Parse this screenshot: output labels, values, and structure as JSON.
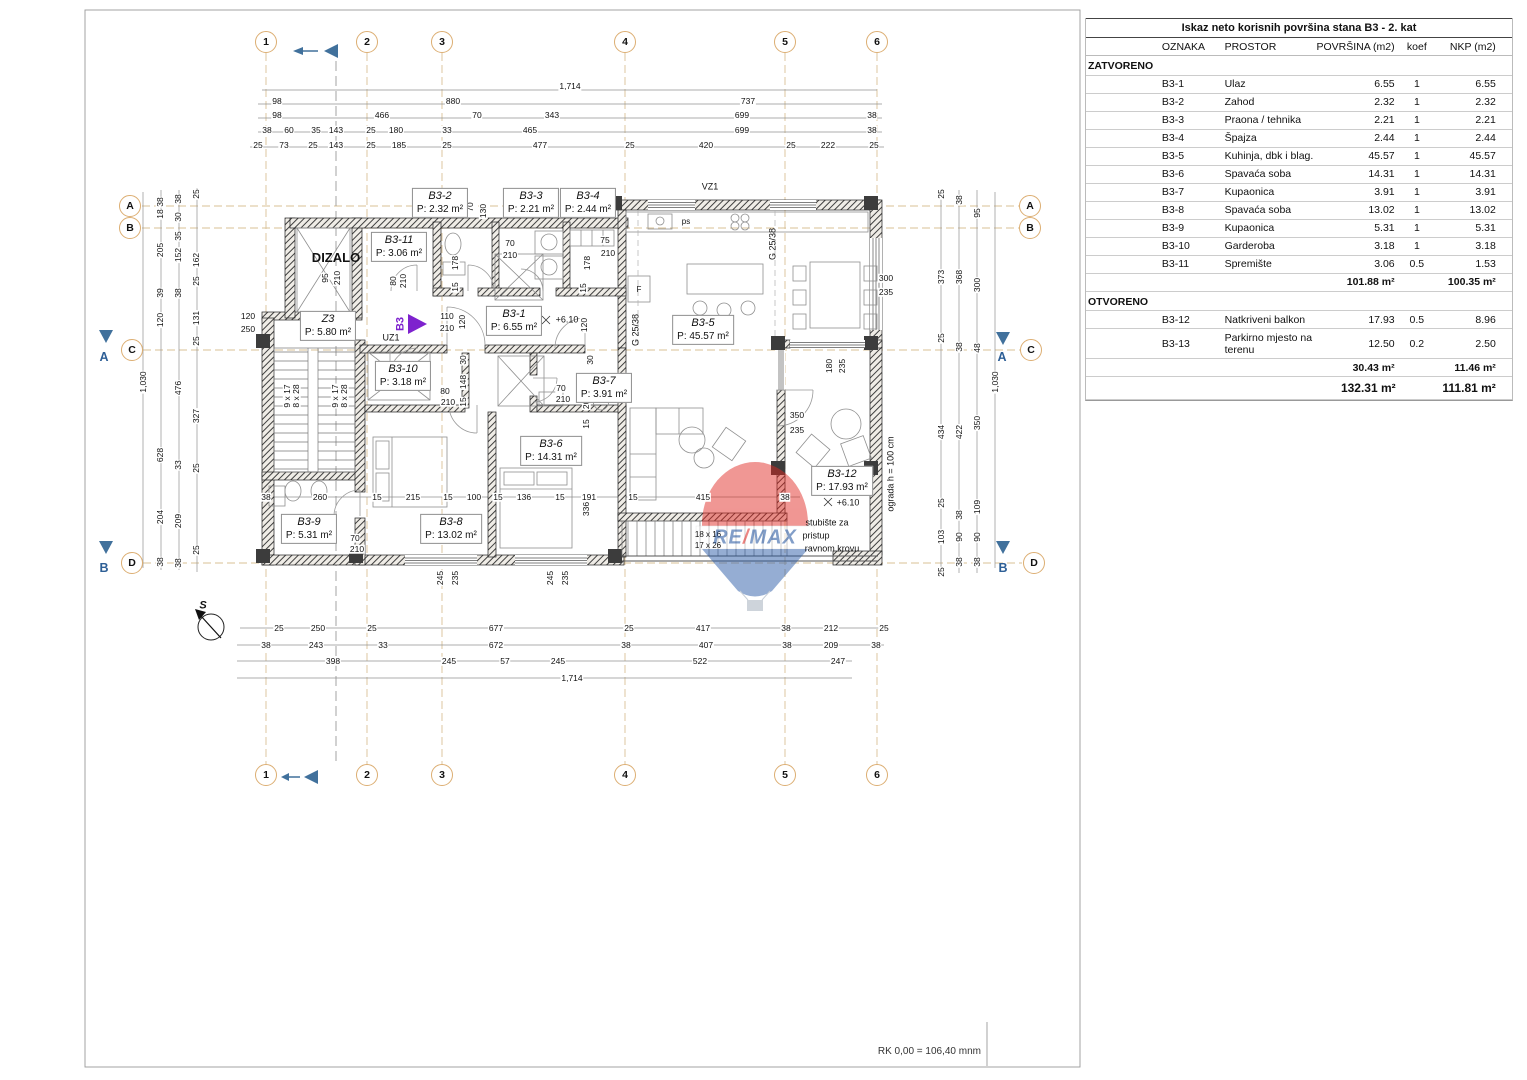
{
  "sheet": {
    "footer": "RK 0,00 = 106,40 mnm"
  },
  "watermark": {
    "re": "RE",
    "slash": "/",
    "max": "MAX"
  },
  "colors": {
    "grid_tan": "#d9c196",
    "bubble_border": "#dcae72",
    "accent_blue": "#41719c",
    "marker_purple": "#7e22ce",
    "remax_red": "#e0251f",
    "remax_blue": "#1d4f9c"
  },
  "table": {
    "title": "Iskaz neto korisnih površina stana B3 - 2. kat",
    "columns": [
      "OZNAKA",
      "PROSTOR",
      "POVRŠINA (m2)",
      "koef",
      "NKP (m2)"
    ],
    "sections": [
      {
        "name": "ZATVORENO",
        "rows": [
          [
            "B3-1",
            "Ulaz",
            "6.55",
            "1",
            "6.55"
          ],
          [
            "B3-2",
            "Zahod",
            "2.32",
            "1",
            "2.32"
          ],
          [
            "B3-3",
            "Praona / tehnika",
            "2.21",
            "1",
            "2.21"
          ],
          [
            "B3-4",
            "Špajza",
            "2.44",
            "1",
            "2.44"
          ],
          [
            "B3-5",
            "Kuhinja, dbk i blag.",
            "45.57",
            "1",
            "45.57"
          ],
          [
            "B3-6",
            "Spavaća soba",
            "14.31",
            "1",
            "14.31"
          ],
          [
            "B3-7",
            "Kupaonica",
            "3.91",
            "1",
            "3.91"
          ],
          [
            "B3-8",
            "Spavaća soba",
            "13.02",
            "1",
            "13.02"
          ],
          [
            "B3-9",
            "Kupaonica",
            "5.31",
            "1",
            "5.31"
          ],
          [
            "B3-10",
            "Garderoba",
            "3.18",
            "1",
            "3.18"
          ],
          [
            "B3-11",
            "Spremište",
            "3.06",
            "0.5",
            "1.53"
          ]
        ],
        "subtotal": [
          "101.88 m²",
          "100.35 m²"
        ]
      },
      {
        "name": "OTVORENO",
        "rows": [
          [
            "B3-12",
            "Natkriveni balkon",
            "17.93",
            "0.5",
            "8.96"
          ],
          [
            "B3-13",
            "Parkirno mjesto na terenu",
            "12.50",
            "0.2",
            "2.50"
          ]
        ],
        "subtotal": [
          "30.43 m²",
          "11.46 m²"
        ]
      }
    ],
    "total": [
      "132.31 m²",
      "111.81 m²"
    ]
  },
  "plan": {
    "grid_bubbles": [
      {
        "t": "1",
        "x": 266,
        "y": 42
      },
      {
        "t": "2",
        "x": 367,
        "y": 42
      },
      {
        "t": "3",
        "x": 442,
        "y": 42
      },
      {
        "t": "4",
        "x": 625,
        "y": 42
      },
      {
        "t": "5",
        "x": 785,
        "y": 42
      },
      {
        "t": "6",
        "x": 877,
        "y": 42
      },
      {
        "t": "1",
        "x": 266,
        "y": 775
      },
      {
        "t": "2",
        "x": 367,
        "y": 775
      },
      {
        "t": "3",
        "x": 442,
        "y": 775
      },
      {
        "t": "4",
        "x": 625,
        "y": 775
      },
      {
        "t": "5",
        "x": 785,
        "y": 775
      },
      {
        "t": "6",
        "x": 877,
        "y": 775
      },
      {
        "t": "A",
        "x": 130,
        "y": 206
      },
      {
        "t": "B",
        "x": 130,
        "y": 228
      },
      {
        "t": "C",
        "x": 132,
        "y": 350
      },
      {
        "t": "D",
        "x": 132,
        "y": 563
      },
      {
        "t": "A",
        "x": 1030,
        "y": 206
      },
      {
        "t": "B",
        "x": 1030,
        "y": 228
      },
      {
        "t": "C",
        "x": 1031,
        "y": 350
      },
      {
        "t": "D",
        "x": 1034,
        "y": 563
      }
    ],
    "rooms": [
      {
        "n": "DIZALO",
        "a": "",
        "x": 336,
        "y": 258
      },
      {
        "n": "Z3",
        "a": "P: 5.80 m²",
        "x": 328,
        "y": 326
      },
      {
        "n": "B3-11",
        "a": "P: 3.06 m²",
        "x": 399,
        "y": 247
      },
      {
        "n": "B3-2",
        "a": "P: 2.32 m²",
        "x": 440,
        "y": 203
      },
      {
        "n": "B3-3",
        "a": "P: 2.21 m²",
        "x": 531,
        "y": 203
      },
      {
        "n": "B3-4",
        "a": "P: 2.44 m²",
        "x": 588,
        "y": 203
      },
      {
        "n": "B3-1",
        "a": "P: 6.55 m²",
        "x": 514,
        "y": 321
      },
      {
        "n": "B3-5",
        "a": "P: 45.57 m²",
        "x": 703,
        "y": 330
      },
      {
        "n": "B3-10",
        "a": "P: 3.18 m²",
        "x": 403,
        "y": 376
      },
      {
        "n": "B3-7",
        "a": "P: 3.91 m²",
        "x": 604,
        "y": 388
      },
      {
        "n": "B3-6",
        "a": "P: 14.31 m²",
        "x": 551,
        "y": 451
      },
      {
        "n": "B3-12",
        "a": "P: 17.93 m²",
        "x": 842,
        "y": 481
      },
      {
        "n": "B3-8",
        "a": "P: 13.02 m²",
        "x": 451,
        "y": 529
      },
      {
        "n": "B3-9",
        "a": "P: 5.31 m²",
        "x": 309,
        "y": 529
      }
    ],
    "dims": [
      [
        "1,714",
        570,
        86
      ],
      [
        "98",
        277,
        101
      ],
      [
        "880",
        453,
        101
      ],
      [
        "737",
        748,
        101
      ],
      [
        "98",
        277,
        115
      ],
      [
        "466",
        382,
        115
      ],
      [
        "70",
        477,
        115
      ],
      [
        "343",
        552,
        115
      ],
      [
        "699",
        742,
        115
      ],
      [
        "38",
        872,
        115
      ],
      [
        "38",
        267,
        130
      ],
      [
        "60",
        289,
        130
      ],
      [
        "35",
        316,
        130
      ],
      [
        "143",
        336,
        130
      ],
      [
        "25",
        371,
        130
      ],
      [
        "180",
        396,
        130
      ],
      [
        "33",
        447,
        130
      ],
      [
        "465",
        530,
        130
      ],
      [
        "699",
        742,
        130
      ],
      [
        "38",
        872,
        130
      ],
      [
        "25",
        258,
        145
      ],
      [
        "73",
        284,
        145
      ],
      [
        "25",
        313,
        145
      ],
      [
        "143",
        336,
        145
      ],
      [
        "25",
        371,
        145
      ],
      [
        "185",
        399,
        145
      ],
      [
        "25",
        447,
        145
      ],
      [
        "477",
        540,
        145
      ],
      [
        "25",
        630,
        145
      ],
      [
        "420",
        706,
        145
      ],
      [
        "25",
        791,
        145
      ],
      [
        "222",
        828,
        145
      ],
      [
        "25",
        874,
        145
      ],
      [
        "25",
        279,
        628
      ],
      [
        "250",
        318,
        628
      ],
      [
        "25",
        372,
        628
      ],
      [
        "677",
        496,
        628
      ],
      [
        "25",
        629,
        628
      ],
      [
        "417",
        703,
        628
      ],
      [
        "38",
        786,
        628
      ],
      [
        "212",
        831,
        628
      ],
      [
        "25",
        884,
        628
      ],
      [
        "38",
        266,
        645
      ],
      [
        "243",
        316,
        645
      ],
      [
        "33",
        383,
        645
      ],
      [
        "672",
        496,
        645
      ],
      [
        "38",
        626,
        645
      ],
      [
        "407",
        706,
        645
      ],
      [
        "38",
        787,
        645
      ],
      [
        "209",
        831,
        645
      ],
      [
        "38",
        876,
        645
      ],
      [
        "398",
        333,
        661
      ],
      [
        "245",
        449,
        661
      ],
      [
        "57",
        505,
        661
      ],
      [
        "245",
        558,
        661
      ],
      [
        "522",
        700,
        661
      ],
      [
        "247",
        838,
        661
      ],
      [
        "1,714",
        572,
        678
      ],
      [
        "1,030",
        143,
        382,
        1
      ],
      [
        "38",
        160,
        202,
        1
      ],
      [
        "18",
        160,
        214,
        1
      ],
      [
        "205",
        160,
        250,
        1
      ],
      [
        "39",
        160,
        293,
        1
      ],
      [
        "120",
        160,
        320,
        1
      ],
      [
        "628",
        160,
        455,
        1
      ],
      [
        "204",
        160,
        517,
        1
      ],
      [
        "38",
        160,
        562,
        1
      ],
      [
        "38",
        178,
        199,
        1
      ],
      [
        "30",
        178,
        217,
        1
      ],
      [
        "35",
        178,
        236,
        1
      ],
      [
        "152",
        178,
        255,
        1
      ],
      [
        "38",
        178,
        293,
        1
      ],
      [
        "476",
        178,
        388,
        1
      ],
      [
        "33",
        178,
        465,
        1
      ],
      [
        "209",
        178,
        521,
        1
      ],
      [
        "38",
        178,
        563,
        1
      ],
      [
        "25",
        196,
        194,
        1
      ],
      [
        "162",
        196,
        260,
        1
      ],
      [
        "25",
        196,
        281,
        1
      ],
      [
        "131",
        196,
        318,
        1
      ],
      [
        "25",
        196,
        341,
        1
      ],
      [
        "327",
        196,
        416,
        1
      ],
      [
        "25",
        196,
        468,
        1
      ],
      [
        "25",
        196,
        550,
        1
      ],
      [
        "25",
        941,
        194,
        1
      ],
      [
        "373",
        941,
        277,
        1
      ],
      [
        "25",
        941,
        338,
        1
      ],
      [
        "434",
        941,
        432,
        1
      ],
      [
        "25",
        941,
        503,
        1
      ],
      [
        "103",
        941,
        537,
        1
      ],
      [
        "25",
        941,
        572,
        1
      ],
      [
        "38",
        959,
        200,
        1
      ],
      [
        "368",
        959,
        277,
        1
      ],
      [
        "38",
        959,
        347,
        1
      ],
      [
        "422",
        959,
        432,
        1
      ],
      [
        "38",
        959,
        515,
        1
      ],
      [
        "90",
        959,
        537,
        1
      ],
      [
        "38",
        959,
        562,
        1
      ],
      [
        "95",
        977,
        213,
        1
      ],
      [
        "300",
        977,
        285,
        1
      ],
      [
        "48",
        977,
        348,
        1
      ],
      [
        "350",
        977,
        423,
        1
      ],
      [
        "109",
        977,
        507,
        1
      ],
      [
        "90",
        977,
        537,
        1
      ],
      [
        "38",
        977,
        562,
        1
      ],
      [
        "1,030",
        995,
        382,
        1
      ],
      [
        "38",
        266,
        497
      ],
      [
        "260",
        320,
        497
      ],
      [
        "15",
        377,
        497
      ],
      [
        "215",
        413,
        497
      ],
      [
        "15",
        448,
        497
      ],
      [
        "100",
        474,
        497
      ],
      [
        "15",
        498,
        497
      ],
      [
        "136",
        524,
        497
      ],
      [
        "15",
        560,
        497
      ],
      [
        "191",
        589,
        497
      ],
      [
        "15",
        633,
        497
      ],
      [
        "415",
        703,
        497
      ],
      [
        "38",
        785,
        497
      ],
      [
        "336",
        586,
        509,
        1
      ],
      [
        "245",
        440,
        578,
        1
      ],
      [
        "235",
        455,
        578,
        1
      ],
      [
        "245",
        550,
        578,
        1
      ],
      [
        "235",
        565,
        578,
        1
      ],
      [
        "70",
        470,
        207,
        1
      ],
      [
        "130",
        483,
        211,
        1
      ],
      [
        "178",
        455,
        263,
        1
      ],
      [
        "15",
        455,
        287,
        1
      ],
      [
        "178",
        587,
        263,
        1
      ],
      [
        "15",
        583,
        288,
        1
      ],
      [
        "95",
        325,
        278,
        1
      ],
      [
        "210",
        337,
        278,
        1
      ],
      [
        "80",
        393,
        281,
        1
      ],
      [
        "210",
        403,
        281,
        1
      ],
      [
        "110",
        447,
        316
      ],
      [
        "210",
        447,
        328
      ],
      [
        "120",
        462,
        322,
        1
      ],
      [
        "75",
        605,
        240
      ],
      [
        "210",
        608,
        253
      ],
      [
        "70",
        510,
        243
      ],
      [
        "210",
        510,
        255
      ],
      [
        "30",
        463,
        360,
        1
      ],
      [
        "148",
        463,
        382,
        1
      ],
      [
        "15",
        463,
        402,
        1
      ],
      [
        "80",
        445,
        391
      ],
      [
        "210",
        448,
        402
      ],
      [
        "70",
        561,
        388
      ],
      [
        "210",
        563,
        399
      ],
      [
        "30",
        590,
        360,
        1
      ],
      [
        "205",
        586,
        402,
        1
      ],
      [
        "15",
        586,
        424,
        1
      ],
      [
        "120",
        584,
        325,
        1
      ],
      [
        "70",
        355,
        538
      ],
      [
        "210",
        357,
        549
      ],
      [
        "300",
        886,
        278
      ],
      [
        "235",
        886,
        292
      ],
      [
        "350",
        797,
        415
      ],
      [
        "235",
        797,
        430
      ],
      [
        "180",
        829,
        366,
        1
      ],
      [
        "235",
        842,
        366,
        1
      ],
      [
        "120",
        248,
        316
      ],
      [
        "250",
        248,
        329
      ],
      [
        "9 x 17",
        287,
        396,
        1
      ],
      [
        "8 x 28",
        296,
        396,
        1
      ],
      [
        "9 x 17",
        335,
        396,
        1
      ],
      [
        "8 x 28",
        344,
        396,
        1
      ]
    ],
    "notes": [
      [
        "VZ1",
        710,
        187,
        "",
        ""
      ],
      [
        "UZ1",
        391,
        338,
        "",
        ""
      ],
      [
        "+6.10",
        567,
        320,
        "",
        ""
      ],
      [
        "+6.10",
        848,
        503,
        "",
        ""
      ],
      [
        "G 25/38",
        773,
        244,
        "rot",
        ""
      ],
      [
        "G 25/38",
        636,
        330,
        "rot",
        ""
      ],
      [
        "ograda h = 100 cm",
        891,
        474,
        "rot",
        ""
      ],
      [
        "18 x 16",
        708,
        535,
        "sm",
        ""
      ],
      [
        "17 x 26",
        708,
        546,
        "sm",
        ""
      ],
      [
        "stubište za",
        827,
        523,
        "",
        ""
      ],
      [
        "pristup",
        816,
        536,
        "",
        ""
      ],
      [
        "ravnom krovu",
        832,
        549,
        "",
        ""
      ],
      [
        "F",
        639,
        290,
        "sm",
        ""
      ],
      [
        "ps",
        686,
        222,
        "sm",
        ""
      ],
      [
        "S",
        203,
        606,
        "i",
        ""
      ],
      [
        "B3",
        401,
        324,
        "purple",
        ""
      ],
      [
        "A",
        104,
        357,
        "blue",
        ""
      ],
      [
        "B",
        104,
        568,
        "blue",
        ""
      ],
      [
        "A",
        1002,
        357,
        "blue",
        ""
      ],
      [
        "B",
        1003,
        568,
        "blue",
        ""
      ]
    ]
  }
}
